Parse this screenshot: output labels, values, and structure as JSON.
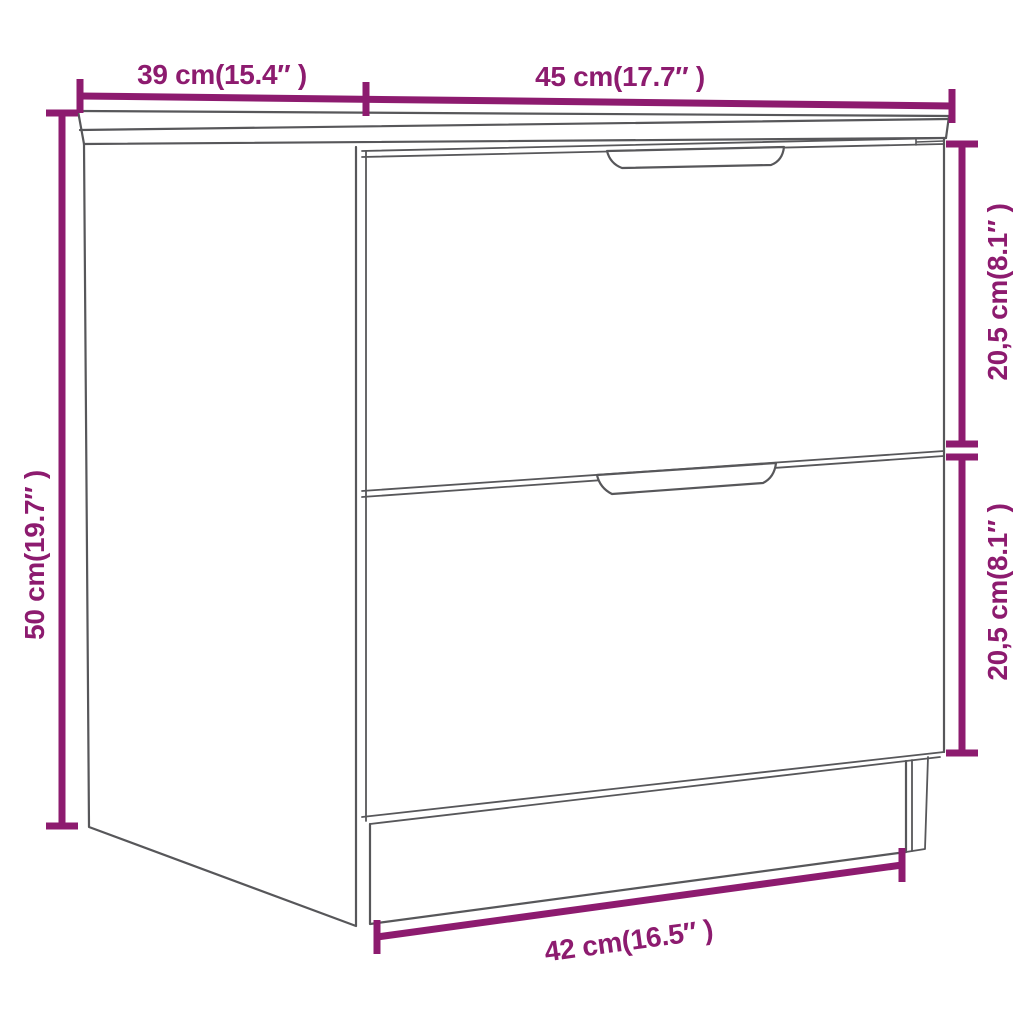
{
  "diagram": {
    "type": "product-dimension-drawing",
    "subject": "two-drawer nightstand line drawing",
    "background": "#ffffff"
  },
  "labels": {
    "depth": "39 cm(15.4″ )",
    "width": "45 cm(17.7″ )",
    "height": "50 cm(19.7″ )",
    "upper_drawer": "20,5 cm(8.1″ )",
    "lower_drawer": "20,5 cm(8.1″ )",
    "base": "42 cm(16.5″ )"
  },
  "colors": {
    "dimension_accent": "#8d1b6f",
    "outline_gray": "#57575a"
  }
}
